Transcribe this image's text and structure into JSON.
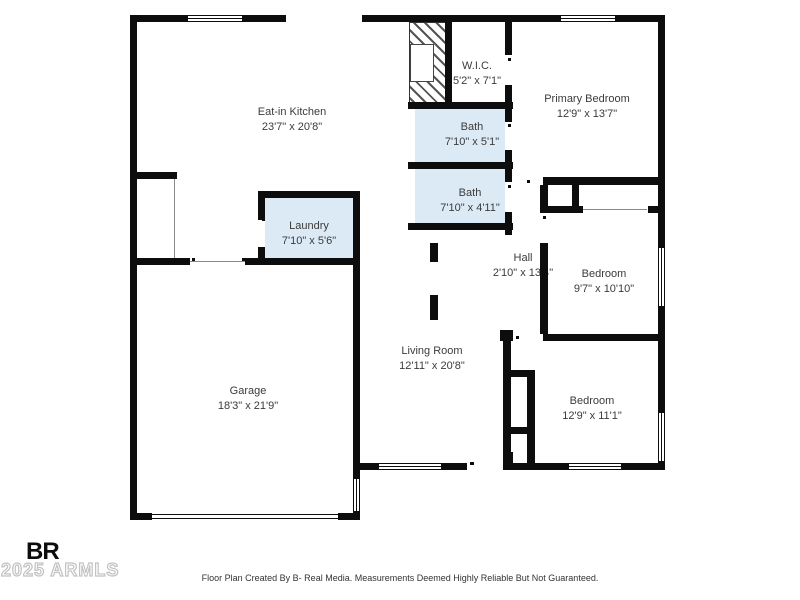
{
  "rooms": {
    "kitchen": {
      "name": "Eat-in Kitchen",
      "dims": "23'7\" x 20'8\""
    },
    "wic": {
      "name": "W.I.C.",
      "dims": "5'2\" x 7'1\""
    },
    "primary_bedroom": {
      "name": "Primary Bedroom",
      "dims": "12'9\" x 13'7\""
    },
    "bath_upper": {
      "name": "Bath",
      "dims": "7'10\" x 5'1\""
    },
    "bath_lower": {
      "name": "Bath",
      "dims": "7'10\" x 4'11\""
    },
    "laundry": {
      "name": "Laundry",
      "dims": "7'10\" x 5'6\""
    },
    "hall": {
      "name": "Hall",
      "dims": "2'10\" x 13'4\""
    },
    "bedroom_middle": {
      "name": "Bedroom",
      "dims": "9'7\" x 10'10\""
    },
    "living_room": {
      "name": "Living Room",
      "dims": "12'11\" x 20'8\""
    },
    "garage": {
      "name": "Garage",
      "dims": "18'3\" x 21'9\""
    },
    "bedroom_bottom": {
      "name": "Bedroom",
      "dims": "12'9\" x 11'1\""
    }
  },
  "branding": {
    "logo_text": "BR",
    "watermark": "2025 ARMLS"
  },
  "footer": {
    "disclaimer": "Floor Plan Created By B- Real Media. Measurements Deemed Highly Reliable But Not Guaranteed."
  },
  "colors": {
    "wall": "#0d0d0d",
    "wet_room_fill": "#dceaf6",
    "label_text": "#3b3b3b",
    "watermark_gray": "#c2c2c2"
  }
}
